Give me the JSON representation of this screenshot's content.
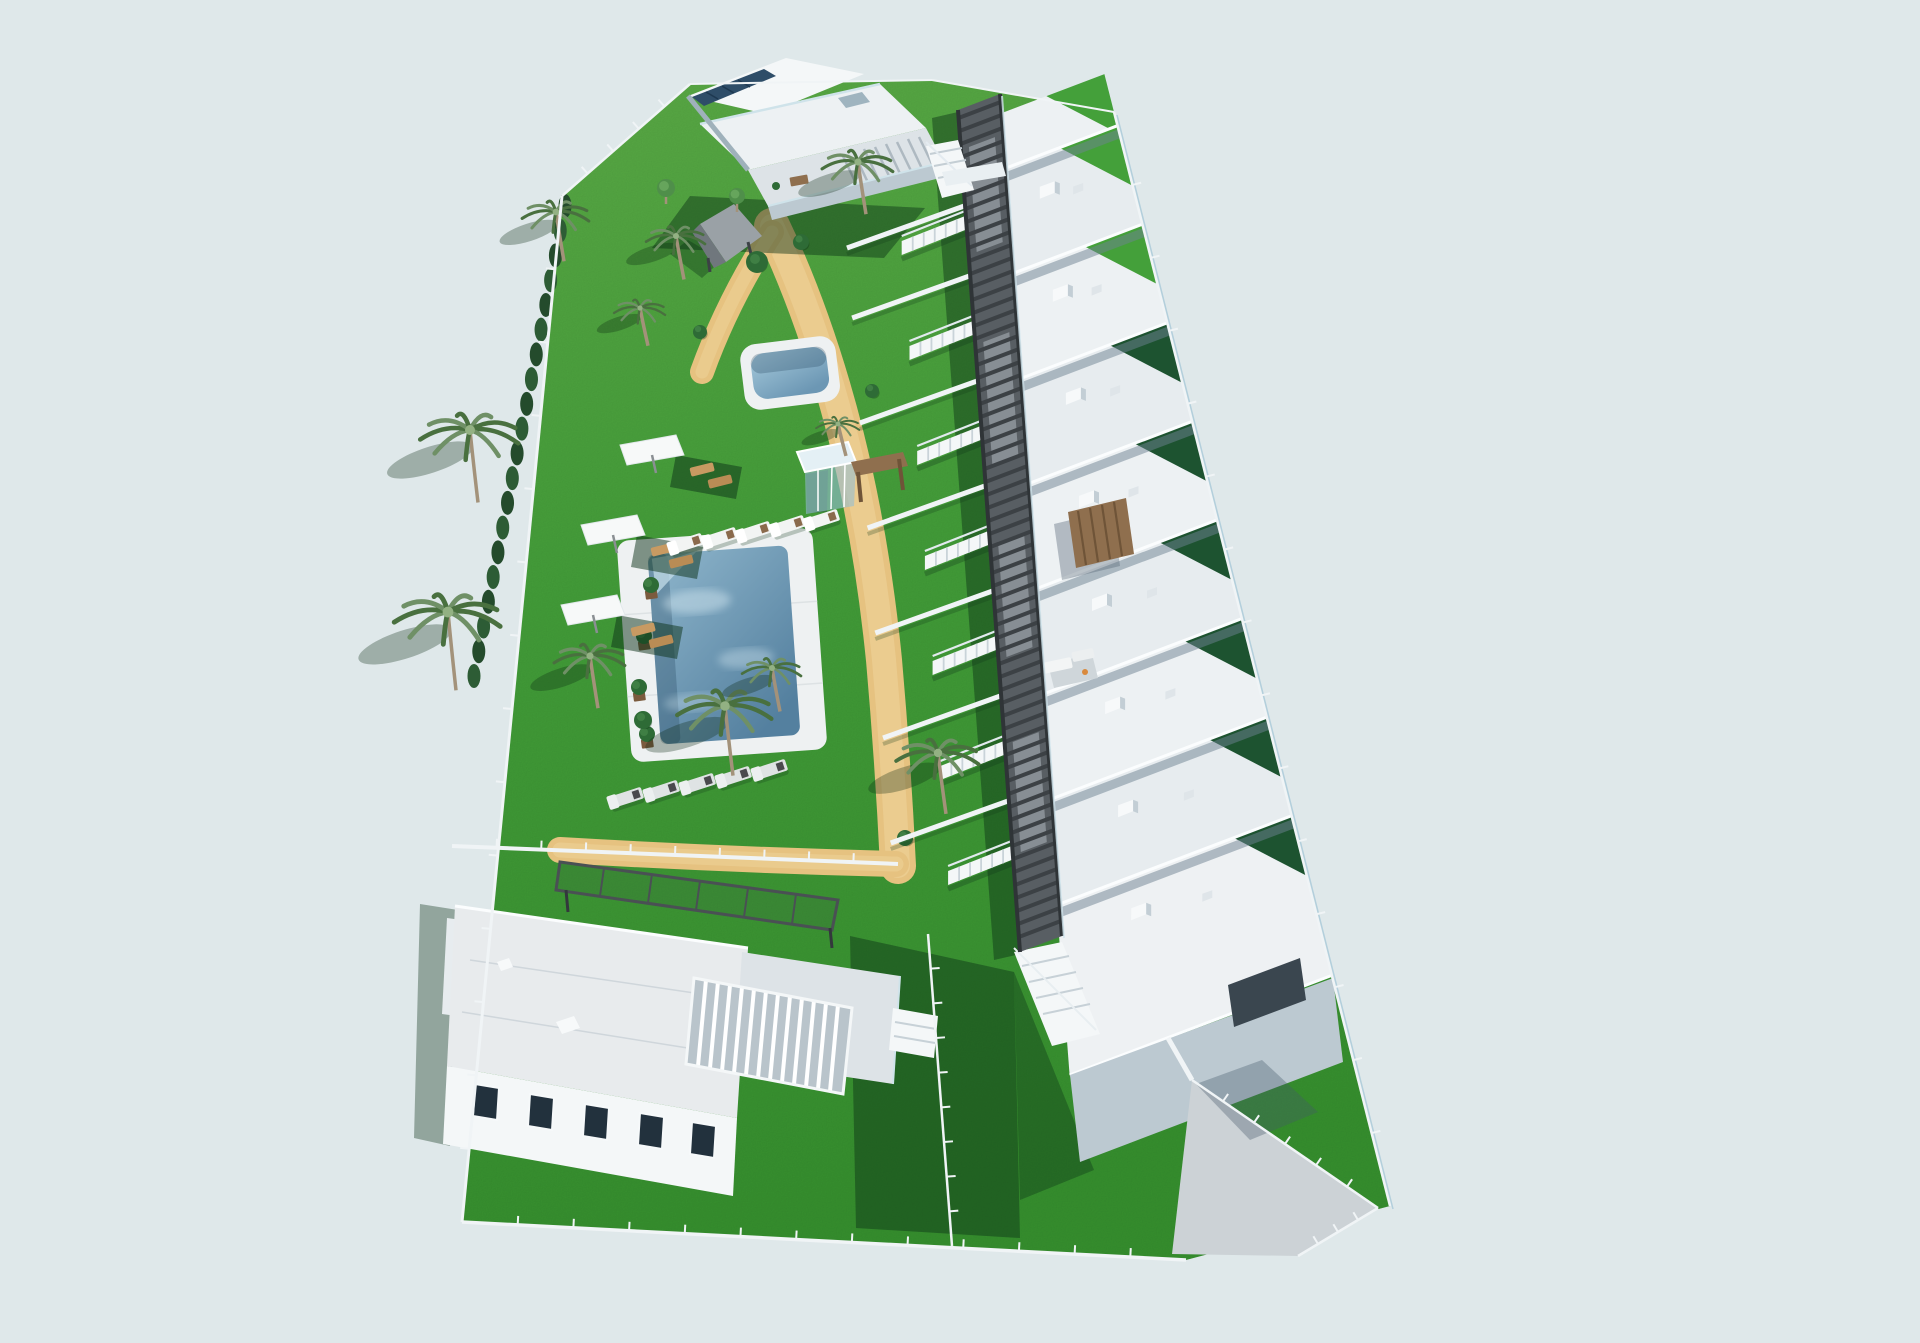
{
  "scene": {
    "title": "Residential complex - aerial 3D render",
    "description": "Aerial 3D architectural visualization of a gated residential development: a row of white terraced houses with roof terraces along a dark slatted pergola walkway, communal gardens with two swimming pools, sun parasols and loungers, palm trees, a cypress hedge, an apartment building at the top, a detached villa at the bottom and a lawn with driveway at the lower right, surrounded by a white perimeter fence."
  },
  "palette": {
    "sky": "#dfe8ea",
    "grass_light": "#5cad47",
    "grass_mid": "#44a03a",
    "grass_dark": "#37922f",
    "grass_shadow": "rgba(10,48,22,0.45)",
    "hedge": "#2d5c35",
    "hedge_dark": "#244b2c",
    "path_sand": "#e6c280",
    "path_light": "#f0d69d",
    "walkway_base": "#585e63",
    "walkway_slat": "#3c4145",
    "walkway_panel": "#8f969c",
    "walkway_edge": "#2f3437",
    "white": "#f4f7f8",
    "roof_light": "#edf1f3",
    "roof_mid": "#e7ecef",
    "roof_dim": "#dde3e7",
    "wall_shadow": "#bcc9d1",
    "wall_deep": "#9fb1bb",
    "glass": "#cfe3ea",
    "solar": "#2e4d68",
    "pool_deep": "#54809f",
    "pool_light": "#8fb6cc",
    "deck": "#eef1f2",
    "wood": "#8f6f4e",
    "wood_dark": "#6f5438",
    "tan": "#c89a62",
    "fence": "#f0f4f6",
    "driveway": "#ccd2d6",
    "trunk": "#a3927a",
    "frond": "#6f9066",
    "frond_dark": "#49703f",
    "bush": "#2e6b36",
    "window_dark": "#22313d",
    "strip_dark": "#1d5330"
  },
  "walkway": {
    "left": {
      "x": 958,
      "y": 110,
      "k": 0.0736
    },
    "width": 42,
    "skew_slope": 0.38,
    "y0": 118,
    "y1": 940,
    "slat_step": 13,
    "panels": [
      [
        150,
        255
      ],
      [
        345,
        470
      ],
      [
        545,
        660
      ],
      [
        745,
        855
      ]
    ]
  },
  "row_houses": {
    "dividers": [
      115,
      170,
      275,
      380,
      485,
      590,
      695,
      800,
      905,
      1075
    ],
    "right": {
      "x": 996,
      "y": 106,
      "k": 0.076
    },
    "fence": {
      "x": 1114,
      "y": 112,
      "k": 0.2523
    },
    "div_slope": -0.38
  },
  "stairs_y": [
    215,
    320,
    425,
    530,
    635,
    740,
    845
  ],
  "walls_y": [
    205,
    275,
    380,
    485,
    590,
    695,
    800
  ],
  "vegetation": {
    "hedge": {
      "x1": 565,
      "y1": 206,
      "x2": 474,
      "y2": 676,
      "count": 20
    },
    "palms": [
      {
        "x": 556,
        "y": 212,
        "r": 34
      },
      {
        "x": 640,
        "y": 308,
        "r": 26
      },
      {
        "x": 470,
        "y": 430,
        "r": 50
      },
      {
        "x": 448,
        "y": 612,
        "r": 54
      },
      {
        "x": 590,
        "y": 656,
        "r": 36
      },
      {
        "x": 725,
        "y": 706,
        "r": 48
      },
      {
        "x": 772,
        "y": 668,
        "r": 30
      },
      {
        "x": 938,
        "y": 753,
        "r": 42
      },
      {
        "x": 858,
        "y": 162,
        "r": 36
      },
      {
        "x": 676,
        "y": 236,
        "r": 30
      },
      {
        "x": 838,
        "y": 424,
        "r": 22
      }
    ],
    "bushes": [
      {
        "x": 757,
        "y": 262,
        "r": 11
      },
      {
        "x": 801,
        "y": 242,
        "r": 8
      },
      {
        "x": 643,
        "y": 720,
        "r": 9
      },
      {
        "x": 872,
        "y": 391,
        "r": 7
      },
      {
        "x": 700,
        "y": 332,
        "r": 7
      },
      {
        "x": 905,
        "y": 838,
        "r": 8
      }
    ],
    "trees": [
      {
        "x": 666,
        "y": 188,
        "r": 9
      },
      {
        "x": 737,
        "y": 196,
        "r": 8
      }
    ],
    "planters": [
      {
        "x": 651,
        "y": 592
      },
      {
        "x": 644,
        "y": 643
      },
      {
        "x": 639,
        "y": 694
      },
      {
        "x": 647,
        "y": 741
      }
    ]
  },
  "furniture": {
    "umbrellas": [
      {
        "x": 650,
        "y": 447
      },
      {
        "x": 611,
        "y": 527
      },
      {
        "x": 591,
        "y": 607
      }
    ],
    "pool_loungers": [
      {
        "x": 672,
        "y": 542
      },
      {
        "x": 706,
        "y": 536
      },
      {
        "x": 740,
        "y": 530
      },
      {
        "x": 774,
        "y": 524
      },
      {
        "x": 808,
        "y": 518
      }
    ],
    "south_loungers": [
      {
        "x": 612,
        "y": 796
      },
      {
        "x": 648,
        "y": 789
      },
      {
        "x": 684,
        "y": 782
      },
      {
        "x": 720,
        "y": 775
      },
      {
        "x": 756,
        "y": 768
      }
    ]
  },
  "fences": [
    {
      "x1": 562,
      "y1": 196,
      "x2": 690,
      "y2": 84,
      "posts": 4,
      "w": 2.5
    },
    {
      "x1": 690,
      "y1": 84,
      "x2": 932,
      "y2": 80,
      "posts": 0,
      "w": 2
    },
    {
      "x1": 932,
      "y1": 80,
      "x2": 1114,
      "y2": 112,
      "posts": 0,
      "w": 2
    },
    {
      "x1": 1114,
      "y1": 112,
      "x2": 1390,
      "y2": 1206,
      "posts": 14,
      "w": 2.5,
      "glass": true
    },
    {
      "x1": 562,
      "y1": 196,
      "x2": 462,
      "y2": 1222,
      "posts": 13,
      "w": 3
    },
    {
      "x1": 462,
      "y1": 1222,
      "x2": 1186,
      "y2": 1260,
      "posts": 12,
      "w": 3.5
    },
    {
      "x1": 928,
      "y1": 934,
      "x2": 952,
      "y2": 1246,
      "posts": 8,
      "w": 2.5
    },
    {
      "x1": 1192,
      "y1": 1080,
      "x2": 1378,
      "y2": 1208,
      "posts": 5,
      "w": 2.5
    },
    {
      "x1": 1378,
      "y1": 1208,
      "x2": 1298,
      "y2": 1256,
      "posts": 3,
      "w": 2.5
    },
    {
      "x1": 452,
      "y1": 846,
      "x2": 898,
      "y2": 864,
      "posts": 9,
      "w": 4
    },
    {
      "x1": 1168,
      "y1": 1038,
      "x2": 1192,
      "y2": 1080,
      "posts": 0,
      "w": 5
    }
  ]
}
